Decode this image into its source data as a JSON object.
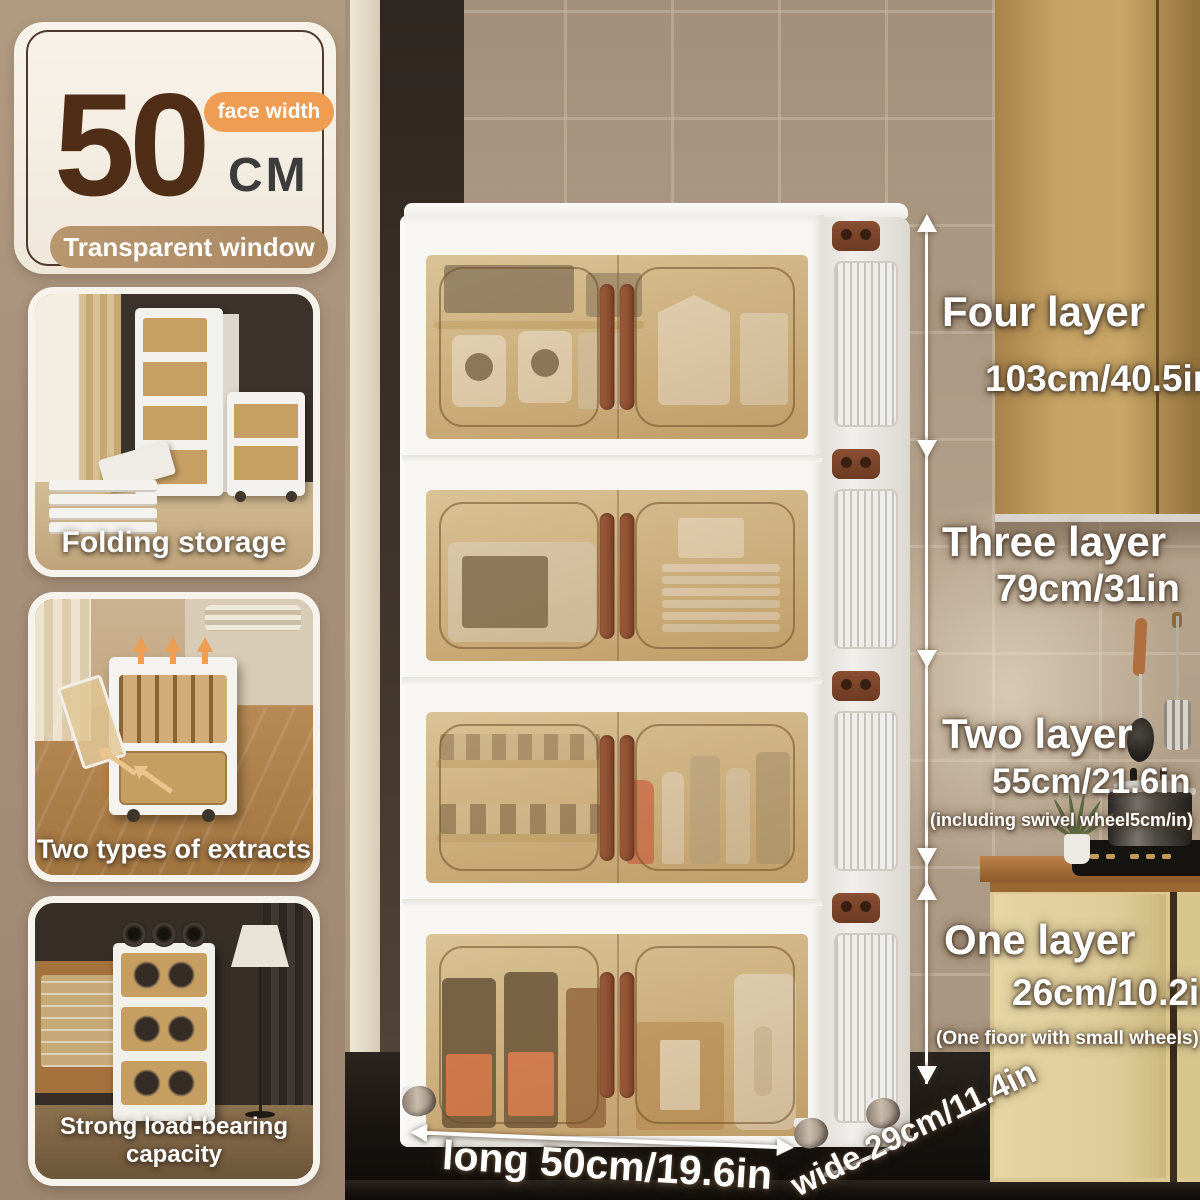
{
  "size_badge": {
    "value": "50",
    "unit": "CM",
    "tag": "face width",
    "banner": "Transparent window"
  },
  "features": [
    {
      "caption": "Folding storage"
    },
    {
      "caption": "Two types of extracts"
    },
    {
      "caption": "Strong load-bearing capacity"
    }
  ],
  "height_labels": [
    {
      "label": "Four layer",
      "size": "103cm/40.5in",
      "note": ""
    },
    {
      "label": "Three layer",
      "size": "79cm/31in",
      "note": ""
    },
    {
      "label": "Two layer",
      "size": "55cm/21.6in",
      "note": "(including swivel wheel5cm/in)"
    },
    {
      "label": "One layer",
      "size": "26cm/10.2in",
      "note": "(One fioor with small wheels)"
    }
  ],
  "floor_dimensions": {
    "length": "long 50cm/19.6in",
    "width": "wide 29cm/11.4in"
  },
  "colors": {
    "accent_orange": "#ef9d52",
    "banner_tan": "#b2916d",
    "number_brown": "#4f2d16",
    "door_amber": "#c89f63",
    "handle_brown": "#8a4f33",
    "annotation_text": "#ffffff"
  }
}
